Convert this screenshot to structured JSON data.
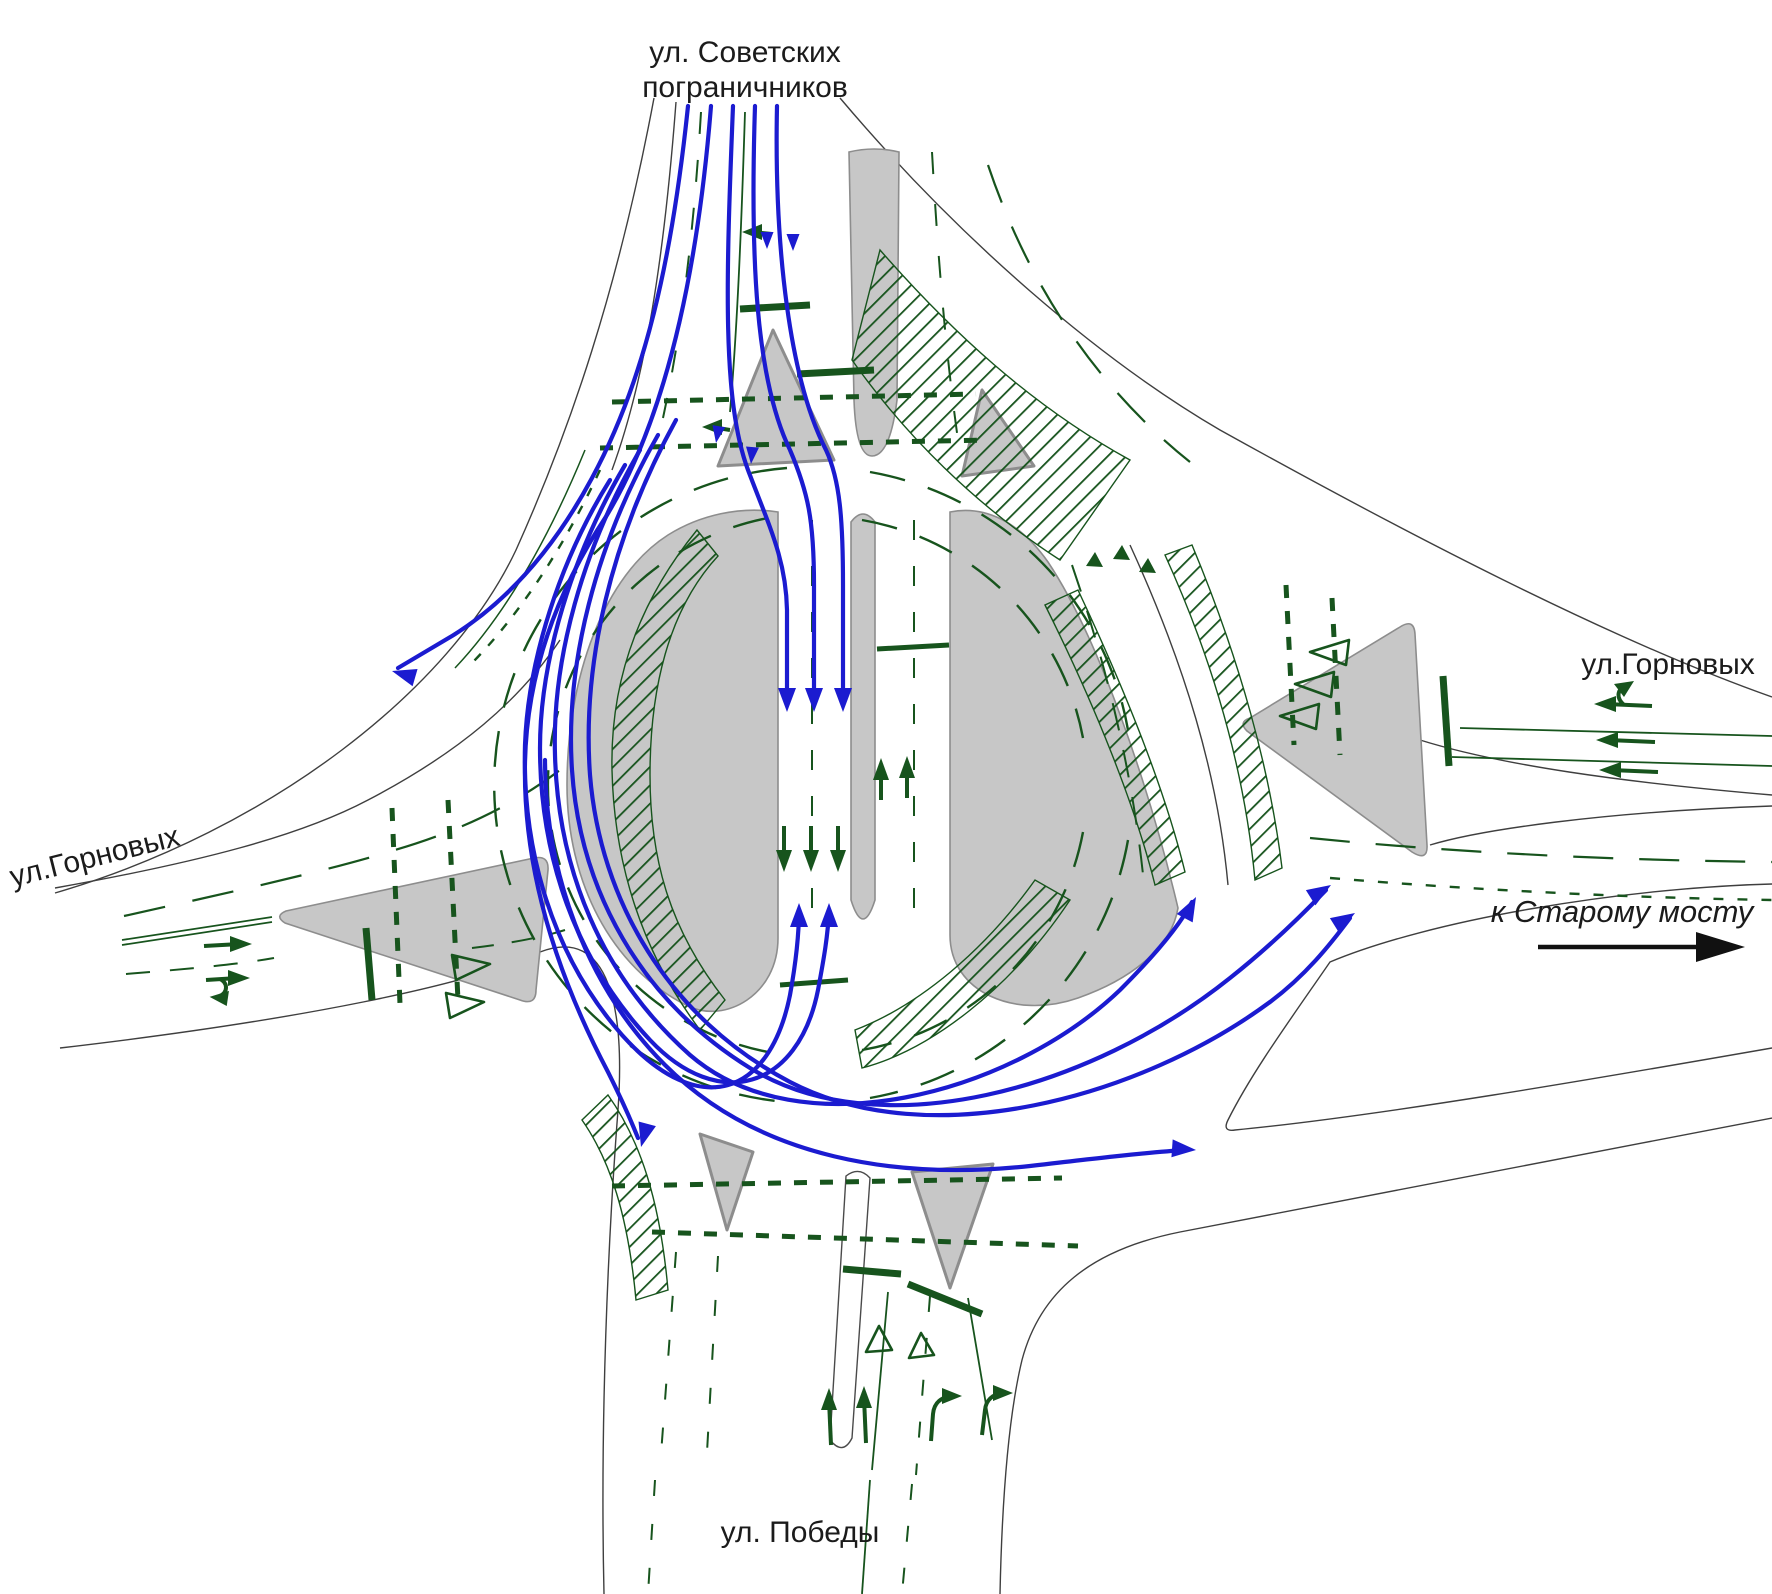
{
  "labels": {
    "street_north_line1": "ул. Советских",
    "street_north_line2": "пограничников",
    "street_west": "ул.Горновых",
    "street_east": "ул.Горновых",
    "street_south": "ул. Победы",
    "direction_east": "к Старому мосту"
  },
  "colors": {
    "background": "#ffffff",
    "road_edge": "#3f3f3f",
    "marking_green": "#17541d",
    "trajectory_blue": "#1b1bd0",
    "island_fill": "#c7c7c7",
    "island_border": "#8d8d8d",
    "text": "#1b1b1b"
  },
  "icons": {
    "direction_east_arrow": "arrow-right",
    "trajectory_arrow": "blue-route-arrow",
    "lane_arrow": "green-lane-arrow",
    "yield_mark": "hollow-triangle"
  }
}
